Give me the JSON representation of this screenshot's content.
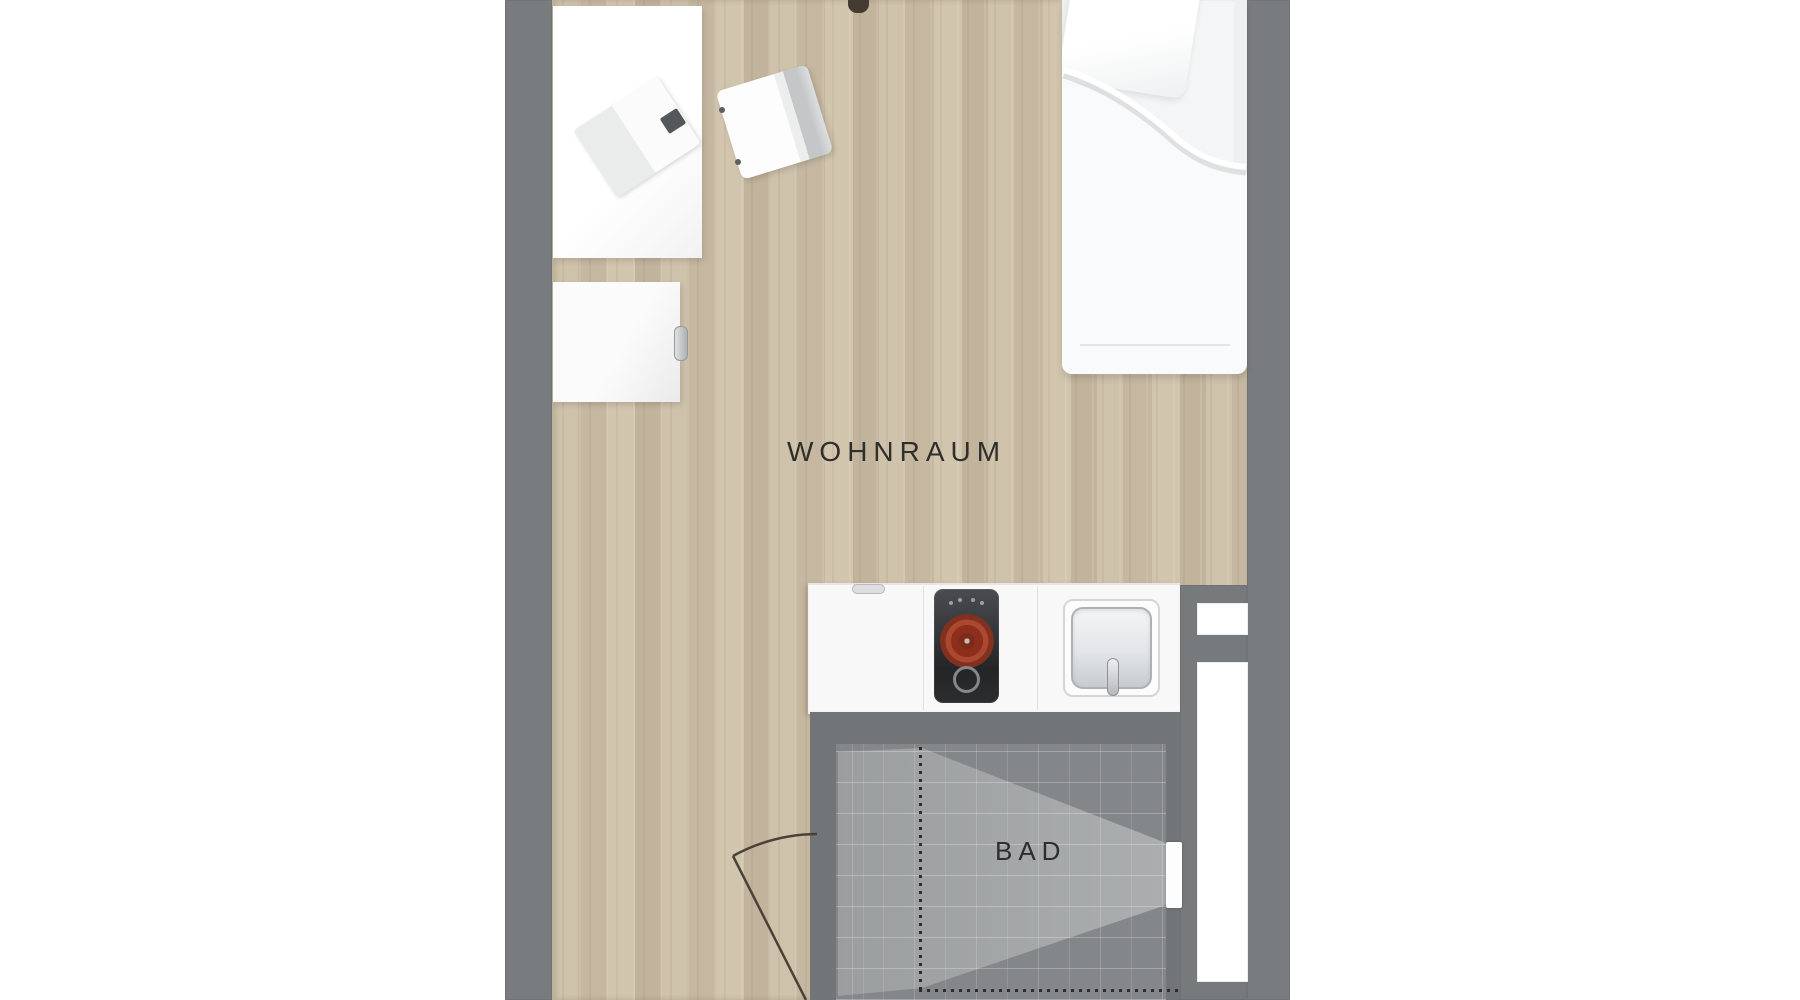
{
  "floorplan": {
    "room_labels": {
      "living_room": "WOHNRAUM",
      "bathroom": "BAD"
    },
    "colors": {
      "background": "#ffffff",
      "wall_gray": "#797c7e",
      "wood_floor": "#cbbda4",
      "tile_dark": "#727578",
      "tile_light": "#a4a7a8",
      "kitchen_counter": "#f8f8f8",
      "burner_red": "#a0432e",
      "door_line": "#4a4238",
      "label_text": "#2f2e2a"
    },
    "elements": {
      "bed": "single-bed",
      "desk": "desk",
      "laptop": "laptop",
      "chair": "desk-chair",
      "cabinet": "cabinet",
      "kitchenette": "counter-with-cooktop-and-sink",
      "cooktop_burner_count": 2,
      "sink": "kitchen-sink",
      "bathroom_door": "bath-door-opening",
      "entrance_door": "door-swing-arc",
      "wall_niche_count": 2
    }
  }
}
